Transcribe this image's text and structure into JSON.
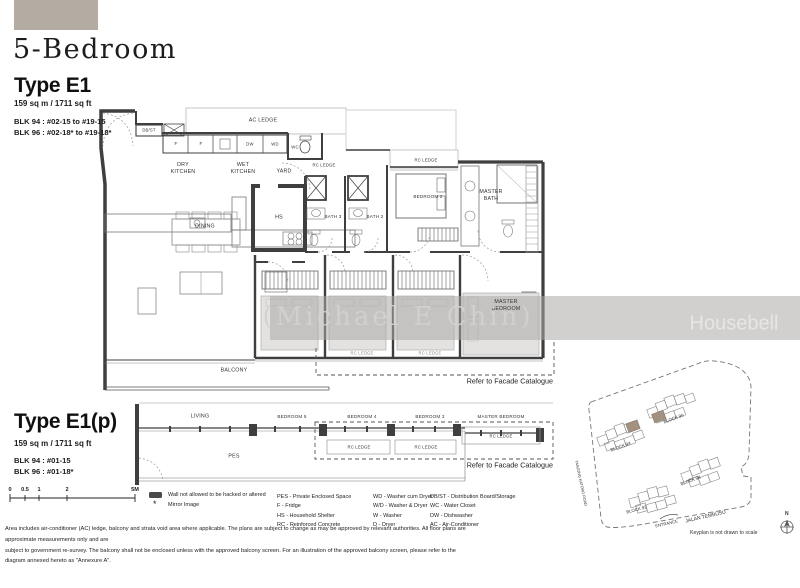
{
  "page": {
    "title": "5-Bedroom"
  },
  "watermark": {
    "agent": "(Michael E Chin)",
    "brand": "Housebell"
  },
  "plan_e1": {
    "name": "Type E1",
    "area": "159 sq m / 1711 sq ft",
    "block_lines": [
      "BLK 94 : #02-15 to #19-15",
      "BLK 96 : #02-18* to #19-18*"
    ],
    "facade_note": "Refer to Facade Catalogue",
    "rooms": {
      "ac_ledge": "AC LEDGE",
      "rc_ledge": "RC LEDGE",
      "db_st": "DB/ST",
      "fridge": "F",
      "dw": "DW",
      "wd": "WD",
      "wc": "WC",
      "dry_kitchen": "DRY KITCHEN",
      "wet_kitchen": "WET KITCHEN",
      "yard": "YARD",
      "hs": "HS",
      "dining": "DINING",
      "bath3": "BATH 3",
      "bath2": "BATH 2",
      "bedroom2": "BEDROOM 2",
      "master_bath": "MASTER BATH",
      "master_bedroom": "MASTER BEDROOM",
      "balcony": "BALCONY"
    }
  },
  "plan_e1p": {
    "name": "Type E1(p)",
    "area": "159 sq m / 1711 sq ft",
    "block_lines": [
      "BLK 94 : #01-15",
      "BLK 96 : #01-18*"
    ],
    "facade_note": "Refer to Facade Catalogue",
    "rooms": {
      "living": "LIVING",
      "bedroom5": "BEDROOM 5",
      "bedroom4": "BEDROOM 4",
      "bedroom3": "BEDROOM 3",
      "master_bedroom": "MASTER BEDROOM",
      "pes": "PES",
      "rc_ledge": "RC LEDGE"
    }
  },
  "scale_bar": {
    "labels": [
      "0",
      "0.5",
      "1",
      "2",
      "5M"
    ]
  },
  "legend": {
    "wall_note": "Wall not allowed to be hacked or altered",
    "mirror_mark": "*",
    "mirror_note": "Mirror Image",
    "columns": [
      [
        "PES - Private Enclosed Space",
        "F - Fridge",
        "HS - Household Shelter",
        "RC - Reinforced Concrete"
      ],
      [
        "WD - Washer cum Dryer",
        "W/D - Washer & Dryer",
        "W - Washer",
        "D - Dryer"
      ],
      [
        "DB/ST - Distribution Board/Storage",
        "WC - Water Closet",
        "DW - Dishwasher",
        "AC - Air-Conditioner"
      ]
    ]
  },
  "disclaimer": {
    "lines": [
      "Area includes air-conditioner (AC) ledge, balcony and strata void area where applicable. The plans are subject to change as may be approved by relevant authorities. All floor plans are approximate measurements only and are",
      "subject to government re-survey. The balcony shall not be enclosed unless with the approved balcony screen. For an illustration of the approved balcony screen, please refer to the diagram annexed hereto as \"Annexure A\"."
    ]
  },
  "keyplan": {
    "blocks": [
      "BLOCK 94",
      "BLOCK 96",
      "BLOCK 92",
      "BLOCK 98"
    ],
    "road_left": "TANJONG KATONG ROAD",
    "road_bottom": "JALAN TEMBUSU",
    "entrance": "ENTRANCE",
    "compass": "N",
    "note": "Keyplan is not drawn to scale",
    "highlight_color": "#a39181"
  },
  "colors": {
    "header_swatch": "#b4aba2",
    "wall": "#3f3f3f",
    "watermark_band": "#aca9a6"
  }
}
